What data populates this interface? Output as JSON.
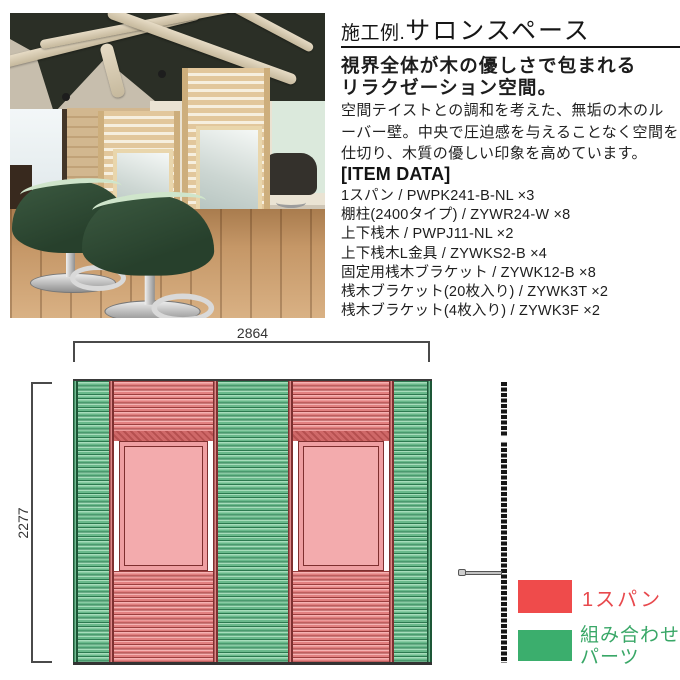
{
  "header": {
    "title_prefix": "施工例.",
    "title_main": "サロンスペース",
    "subtitle_line1": "視界全体が木の優しさで包まれる",
    "subtitle_line2": "リラクゼーション空間。",
    "description": "空間テイストとの調和を考えた、無垢の木のルーバー壁。中央で圧迫感を与えることなく空間を仕切り、木質の優しい印象を高めています。"
  },
  "item_data": {
    "heading": "[ITEM DATA]",
    "items": [
      "1スパン / PWPK241-B-NL ×3",
      "棚柱(2400タイプ) / ZYWR24-W ×8",
      "上下桟木 / PWPJ11-NL ×2",
      "上下桟木L金具 / ZYWKS2-B ×4",
      "固定用桟木ブラケット / ZYWK12-B ×8",
      "桟木ブラケット(20枚入り) / ZYWK3T ×2",
      "桟木ブラケット(4枚入り) / ZYWK3F ×2"
    ]
  },
  "diagram": {
    "width_label": "2864",
    "height_label": "2277",
    "legend": {
      "span": {
        "label": "1スパン",
        "color": "#ef4b4b"
      },
      "combo": {
        "label_line1": "組み合わせ",
        "label_line2": "パーツ",
        "color": "#3bae6d"
      }
    },
    "colors": {
      "red_slat": "#e28080",
      "red_dark": "#9c3e3e",
      "green_slat": "#69b98b",
      "green_dark": "#2c7a50",
      "window_fill": "#f3abad"
    }
  }
}
